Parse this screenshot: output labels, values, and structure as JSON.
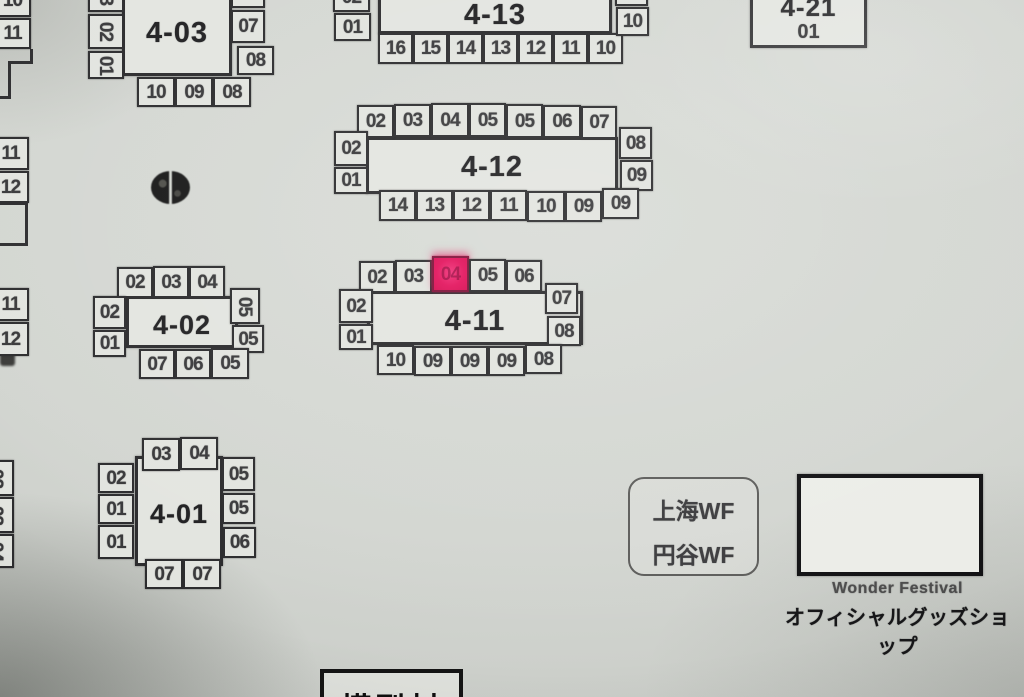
{
  "palette": {
    "paper": "#d3d6d1",
    "ink": "#2c2c2e",
    "box_fill": "#e2e4df",
    "highlight_pink": "#e3125c"
  },
  "legend": {
    "line1": "上海WF",
    "line2": "円谷WF"
  },
  "shop": {
    "caption_en": "Wonder Festival",
    "caption_jp": "オフィシャルグッズショップ"
  },
  "bottom_block": {
    "label": "模型村"
  },
  "highlight": {
    "block": "4-11",
    "seat": "04",
    "color": "#e3125c"
  },
  "blocks": [
    {
      "title": "4-03",
      "rect": [
        122,
        -26,
        110,
        102
      ],
      "title_top": 40,
      "title_size": 29,
      "seats": [
        {
          "t": "03",
          "x": 88,
          "y": -22,
          "w": 36,
          "h": 34,
          "r": 1
        },
        {
          "t": "02",
          "x": 88,
          "y": 14,
          "w": 36,
          "h": 35,
          "r": 1
        },
        {
          "t": "01",
          "x": 88,
          "y": 51,
          "w": 36,
          "h": 28,
          "r": 1
        },
        {
          "t": "06",
          "x": 231,
          "y": -22,
          "w": 34,
          "h": 30
        },
        {
          "t": "07",
          "x": 231,
          "y": 10,
          "w": 34,
          "h": 33
        },
        {
          "t": "08",
          "x": 237,
          "y": 46,
          "w": 37,
          "h": 29
        },
        {
          "t": "10",
          "x": 137,
          "y": 77,
          "w": 38,
          "h": 30
        },
        {
          "t": "09",
          "x": 175,
          "y": 77,
          "w": 38,
          "h": 30
        },
        {
          "t": "08",
          "x": 213,
          "y": 77,
          "w": 38,
          "h": 30
        }
      ]
    },
    {
      "title": "4-13",
      "rect": [
        378,
        -28,
        234,
        62
      ],
      "title_top": 24,
      "title_size": 29,
      "seats": [
        {
          "t": "02",
          "x": 333,
          "y": -18,
          "w": 37,
          "h": 30
        },
        {
          "t": "01",
          "x": 334,
          "y": 13,
          "w": 37,
          "h": 28
        },
        {
          "t": "16",
          "x": 378,
          "y": 33,
          "w": 35,
          "h": 31
        },
        {
          "t": "15",
          "x": 413,
          "y": 33,
          "w": 35,
          "h": 31
        },
        {
          "t": "14",
          "x": 448,
          "y": 33,
          "w": 35,
          "h": 31
        },
        {
          "t": "13",
          "x": 483,
          "y": 33,
          "w": 35,
          "h": 31
        },
        {
          "t": "12",
          "x": 518,
          "y": 33,
          "w": 35,
          "h": 31
        },
        {
          "t": "11",
          "x": 553,
          "y": 33,
          "w": 35,
          "h": 31
        },
        {
          "t": "10",
          "x": 588,
          "y": 33,
          "w": 35,
          "h": 31
        },
        {
          "t": "09",
          "x": 615,
          "y": -22,
          "w": 33,
          "h": 28
        },
        {
          "t": "10",
          "x": 616,
          "y": 7,
          "w": 33,
          "h": 29
        }
      ]
    },
    {
      "title": "4-21",
      "rect": [
        750,
        -18,
        117,
        66
      ],
      "title_top": 6,
      "title_size": 26,
      "sub": "01",
      "sub_top": 36,
      "seats": []
    },
    {
      "title": "4-12",
      "rect": [
        366,
        137,
        252,
        57
      ],
      "title_top": 11,
      "title_size": 29,
      "seats": [
        {
          "t": "02",
          "x": 357,
          "y": 105,
          "w": 37,
          "h": 33
        },
        {
          "t": "03",
          "x": 394,
          "y": 104,
          "w": 37,
          "h": 33
        },
        {
          "t": "04",
          "x": 431,
          "y": 103,
          "w": 38,
          "h": 34
        },
        {
          "t": "05",
          "x": 469,
          "y": 103,
          "w": 37,
          "h": 34
        },
        {
          "t": "05",
          "x": 506,
          "y": 104,
          "w": 37,
          "h": 34
        },
        {
          "t": "06",
          "x": 543,
          "y": 105,
          "w": 38,
          "h": 33
        },
        {
          "t": "07",
          "x": 581,
          "y": 106,
          "w": 36,
          "h": 33
        },
        {
          "t": "02",
          "x": 334,
          "y": 131,
          "w": 34,
          "h": 35
        },
        {
          "t": "01",
          "x": 334,
          "y": 167,
          "w": 34,
          "h": 27
        },
        {
          "t": "08",
          "x": 619,
          "y": 127,
          "w": 33,
          "h": 32
        },
        {
          "t": "09",
          "x": 620,
          "y": 160,
          "w": 33,
          "h": 31
        },
        {
          "t": "14",
          "x": 379,
          "y": 190,
          "w": 37,
          "h": 31
        },
        {
          "t": "13",
          "x": 416,
          "y": 190,
          "w": 37,
          "h": 31
        },
        {
          "t": "12",
          "x": 453,
          "y": 190,
          "w": 37,
          "h": 31
        },
        {
          "t": "11",
          "x": 490,
          "y": 190,
          "w": 37,
          "h": 31
        },
        {
          "t": "10",
          "x": 527,
          "y": 191,
          "w": 38,
          "h": 31
        },
        {
          "t": "09",
          "x": 565,
          "y": 191,
          "w": 37,
          "h": 31
        },
        {
          "t": "09",
          "x": 602,
          "y": 188,
          "w": 37,
          "h": 31
        }
      ]
    },
    {
      "title": "4-11",
      "rect": [
        367,
        291,
        216,
        54
      ],
      "title_top": 11,
      "title_size": 29,
      "seats": [
        {
          "t": "02",
          "x": 359,
          "y": 261,
          "w": 36,
          "h": 32
        },
        {
          "t": "03",
          "x": 395,
          "y": 260,
          "w": 37,
          "h": 33
        },
        {
          "t": "04",
          "x": 432,
          "y": 256,
          "w": 37,
          "h": 36,
          "hl": 1
        },
        {
          "t": "05",
          "x": 469,
          "y": 259,
          "w": 37,
          "h": 33
        },
        {
          "t": "06",
          "x": 506,
          "y": 260,
          "w": 36,
          "h": 32
        },
        {
          "t": "02",
          "x": 339,
          "y": 289,
          "w": 34,
          "h": 34
        },
        {
          "t": "01",
          "x": 339,
          "y": 324,
          "w": 34,
          "h": 26
        },
        {
          "t": "07",
          "x": 545,
          "y": 283,
          "w": 33,
          "h": 31
        },
        {
          "t": "08",
          "x": 547,
          "y": 316,
          "w": 34,
          "h": 30
        },
        {
          "t": "10",
          "x": 377,
          "y": 345,
          "w": 37,
          "h": 30
        },
        {
          "t": "09",
          "x": 414,
          "y": 346,
          "w": 37,
          "h": 30
        },
        {
          "t": "09",
          "x": 451,
          "y": 346,
          "w": 37,
          "h": 30
        },
        {
          "t": "09",
          "x": 488,
          "y": 346,
          "w": 37,
          "h": 30
        },
        {
          "t": "08",
          "x": 525,
          "y": 344,
          "w": 37,
          "h": 30
        }
      ]
    },
    {
      "title": "4-02",
      "rect": [
        126,
        296,
        112,
        52
      ],
      "title_top": 10,
      "title_size": 27,
      "seats": [
        {
          "t": "02",
          "x": 117,
          "y": 267,
          "w": 36,
          "h": 31
        },
        {
          "t": "03",
          "x": 153,
          "y": 266,
          "w": 36,
          "h": 32
        },
        {
          "t": "04",
          "x": 189,
          "y": 266,
          "w": 36,
          "h": 32
        },
        {
          "t": "02",
          "x": 93,
          "y": 296,
          "w": 33,
          "h": 33
        },
        {
          "t": "01",
          "x": 93,
          "y": 330,
          "w": 33,
          "h": 27
        },
        {
          "t": "05",
          "x": 230,
          "y": 288,
          "w": 30,
          "h": 36,
          "r": 1
        },
        {
          "t": "05",
          "x": 232,
          "y": 325,
          "w": 32,
          "h": 28
        },
        {
          "t": "07",
          "x": 139,
          "y": 349,
          "w": 36,
          "h": 30
        },
        {
          "t": "06",
          "x": 175,
          "y": 349,
          "w": 36,
          "h": 30
        },
        {
          "t": "05",
          "x": 211,
          "y": 348,
          "w": 38,
          "h": 31
        }
      ]
    },
    {
      "title": "4-01",
      "rect": [
        135,
        456,
        88,
        110
      ],
      "title_top": 39,
      "title_size": 27,
      "seats": [
        {
          "t": "03",
          "x": 142,
          "y": 438,
          "w": 38,
          "h": 33
        },
        {
          "t": "04",
          "x": 180,
          "y": 437,
          "w": 38,
          "h": 33
        },
        {
          "t": "02",
          "x": 98,
          "y": 463,
          "w": 36,
          "h": 30
        },
        {
          "t": "01",
          "x": 98,
          "y": 494,
          "w": 36,
          "h": 30
        },
        {
          "t": "01",
          "x": 98,
          "y": 525,
          "w": 36,
          "h": 34
        },
        {
          "t": "05",
          "x": 222,
          "y": 457,
          "w": 33,
          "h": 34
        },
        {
          "t": "05",
          "x": 222,
          "y": 493,
          "w": 33,
          "h": 31
        },
        {
          "t": "06",
          "x": 223,
          "y": 527,
          "w": 33,
          "h": 31
        },
        {
          "t": "07",
          "x": 145,
          "y": 559,
          "w": 38,
          "h": 30
        },
        {
          "t": "07",
          "x": 183,
          "y": 559,
          "w": 38,
          "h": 30
        }
      ]
    }
  ],
  "partial_seats": [
    {
      "t": "10",
      "x": -6,
      "y": -16,
      "w": 37,
      "h": 33
    },
    {
      "t": "11",
      "x": -6,
      "y": 18,
      "w": 37,
      "h": 31
    },
    {
      "t": "11",
      "x": -8,
      "y": 137,
      "w": 37,
      "h": 33
    },
    {
      "t": "12",
      "x": -8,
      "y": 171,
      "w": 37,
      "h": 32
    },
    {
      "t": "11",
      "x": -8,
      "y": 288,
      "w": 37,
      "h": 33
    },
    {
      "t": "12",
      "x": -8,
      "y": 322,
      "w": 37,
      "h": 34
    },
    {
      "t": "02",
      "x": -22,
      "y": 460,
      "w": 36,
      "h": 36,
      "r": 1
    },
    {
      "t": "03",
      "x": -22,
      "y": 497,
      "w": 36,
      "h": 36,
      "r": 1
    },
    {
      "t": "04",
      "x": -22,
      "y": 534,
      "w": 36,
      "h": 34,
      "r": 1
    }
  ]
}
